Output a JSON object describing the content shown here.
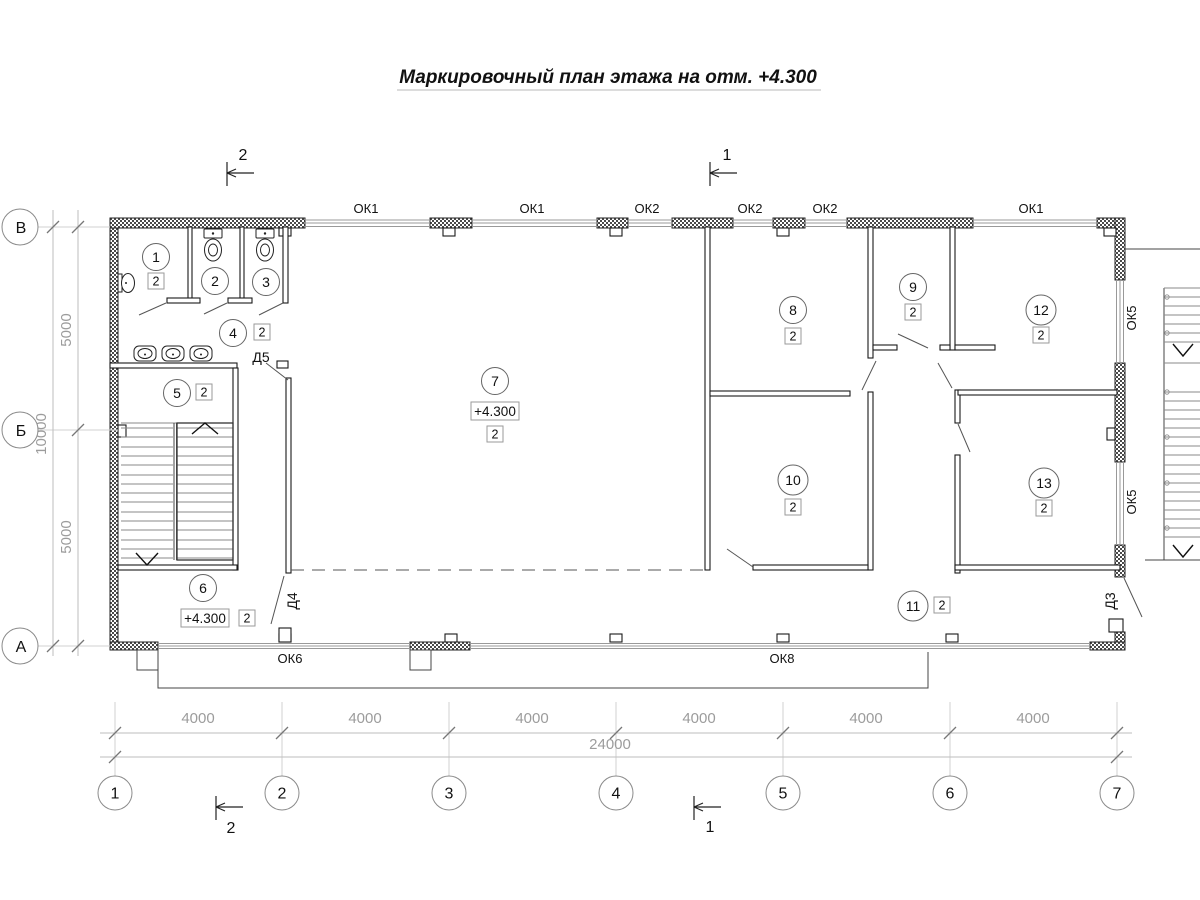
{
  "title": "Маркировочный план этажа на отм. +4.300",
  "rooms": [
    {
      "num": "1",
      "cat": "2"
    },
    {
      "num": "2"
    },
    {
      "num": "3"
    },
    {
      "num": "4",
      "cat": "2"
    },
    {
      "num": "5",
      "cat": "2"
    },
    {
      "num": "6",
      "cat": "2"
    },
    {
      "num": "7",
      "cat": "2"
    },
    {
      "num": "8",
      "cat": "2"
    },
    {
      "num": "9",
      "cat": "2"
    },
    {
      "num": "10",
      "cat": "2"
    },
    {
      "num": "11",
      "cat": "2"
    },
    {
      "num": "12",
      "cat": "2"
    },
    {
      "num": "13",
      "cat": "2"
    }
  ],
  "elevations": [
    "+4.300",
    "+4.300"
  ],
  "windows": {
    "top": [
      "ОК1",
      "ОК1",
      "ОК2",
      "ОК2",
      "ОК2",
      "ОК1"
    ],
    "right": [
      "ОК5",
      "ОК5"
    ],
    "bottom": [
      "ОК6",
      "ОК8"
    ]
  },
  "doors": [
    "Д5",
    "Д4",
    "Д3"
  ],
  "axes": {
    "left": [
      "В",
      "Б",
      "А"
    ],
    "bottom": [
      "1",
      "2",
      "3",
      "4",
      "5",
      "6",
      "7"
    ]
  },
  "dims": {
    "left_spans": [
      "5000",
      "5000"
    ],
    "left_total": "10000",
    "bottom_spans": [
      "4000",
      "4000",
      "4000",
      "4000",
      "4000",
      "4000"
    ],
    "bottom_total": "24000"
  },
  "sections": {
    "top_left": "2",
    "top_right": "1",
    "bottom_left": "2",
    "bottom_right": "1"
  }
}
